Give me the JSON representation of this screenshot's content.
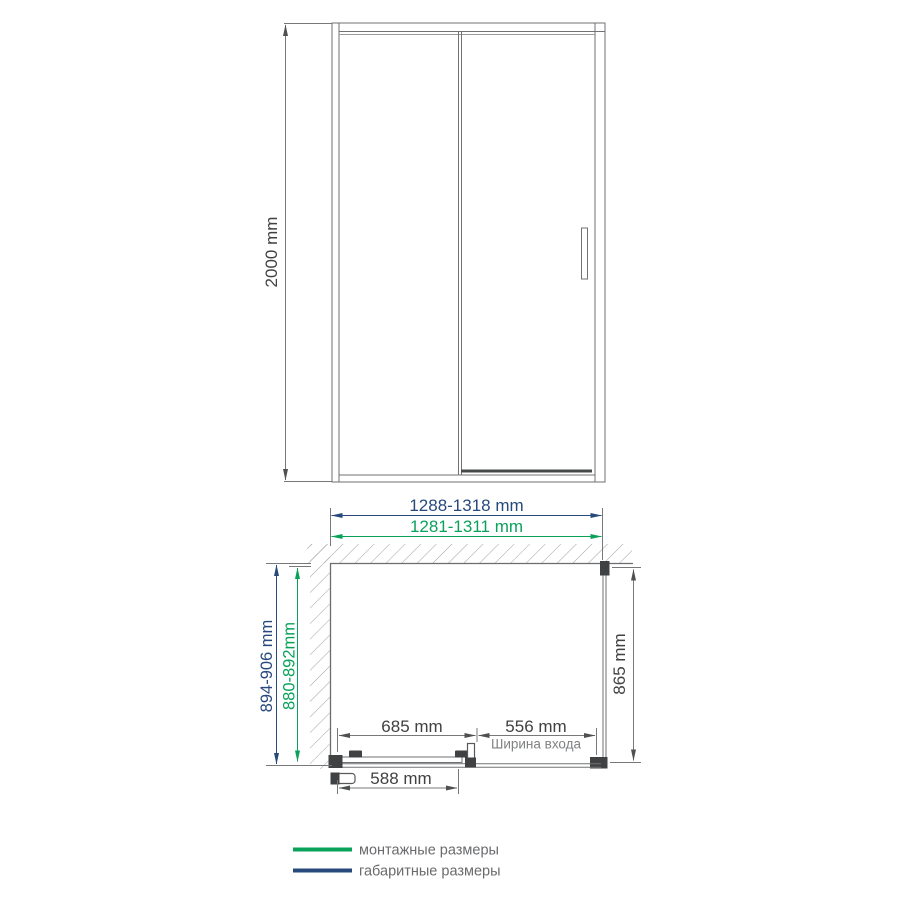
{
  "elevation": {
    "height": "2000 mm"
  },
  "plan": {
    "overall_width": "1288-1318 mm",
    "mounting_width": "1281-1311 mm",
    "overall_depth": "894-906 mm",
    "mounting_depth": "880-892mm",
    "side_panel_depth": "865 mm",
    "fixed_section_width": "685 mm",
    "entry_width": "556 mm",
    "entry_caption": "Ширина входа",
    "door_panel_width": "588 mm"
  },
  "legend": {
    "items": [
      {
        "label": "монтажные размеры",
        "color": "#0aa25b"
      },
      {
        "label": "габаритные размеры",
        "color": "#27497c"
      }
    ]
  },
  "colors": {
    "mounting": "#0aa25b",
    "overall": "#27497c",
    "dim_text": "#414042",
    "dim_arrow": "#4f5052",
    "caption_text": "#7f8183",
    "legend_text": "#6a6b6d",
    "hatch": "#9fa1a4"
  }
}
